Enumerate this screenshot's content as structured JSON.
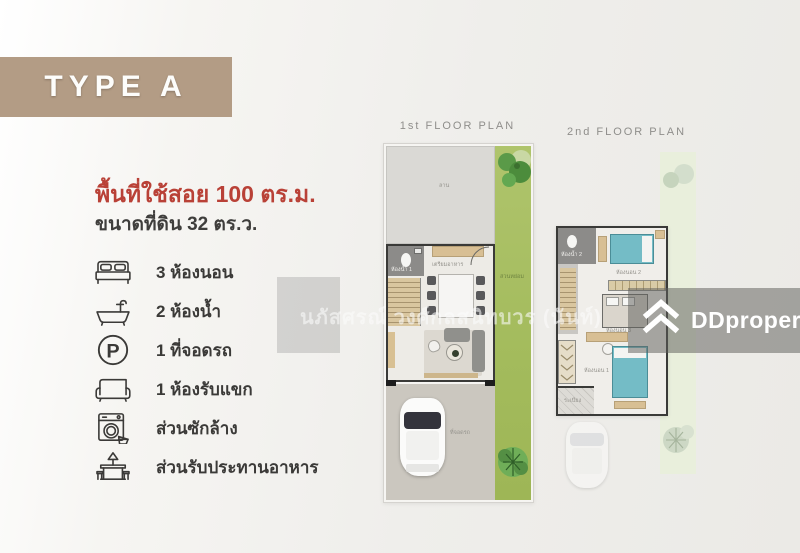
{
  "badge": {
    "label": "TYPE A"
  },
  "summary": {
    "usable_area": "พื้นที่ใช้สอย 100 ตร.ม.",
    "land_size": "ขนาดที่ดิน 32 ตร.ว."
  },
  "amenities": [
    {
      "icon": "bed-icon",
      "label": "3 ห้องนอน"
    },
    {
      "icon": "bathtub-icon",
      "label": "2 ห้องน้ำ"
    },
    {
      "icon": "parking-icon",
      "label": "1 ที่จอดรถ"
    },
    {
      "icon": "sofa-icon",
      "label": "1 ห้องรับแขก"
    },
    {
      "icon": "washing-machine-icon",
      "label": "ส่วนซักล้าง"
    },
    {
      "icon": "dining-table-icon",
      "label": "ส่วนรับประทานอาหาร"
    }
  ],
  "floor_plans": [
    {
      "title": "1st FLOOR PLAN",
      "rooms": {
        "terrace": "ลาน",
        "bathroom": "ห้องน้ำ 1",
        "kitchen": "เตรียมอาหาร",
        "garden": "สวนหย่อม",
        "parking": "ที่จอดรถ"
      }
    },
    {
      "title": "2nd FLOOR PLAN",
      "rooms": {
        "bathroom": "ห้องน้ำ 2",
        "bedroom2": "ห้องนอน 2",
        "bedroom3": "ห้องนอน 3",
        "bedroom1": "ห้องนอน 1",
        "balcony": "ระเบียง"
      }
    }
  ],
  "watermarks": {
    "agent_name": "นภัสศรณ์ วงศ์กลสนิทบวร (นันท์)",
    "brand": "DDproperty"
  },
  "colors": {
    "badge_tan": "#b39c85",
    "accent_red": "#b94137",
    "garden_green": "#a3bb5c",
    "bed_teal": "#74bcc6",
    "watermark_band": "rgba(96,95,92,0.52)"
  }
}
